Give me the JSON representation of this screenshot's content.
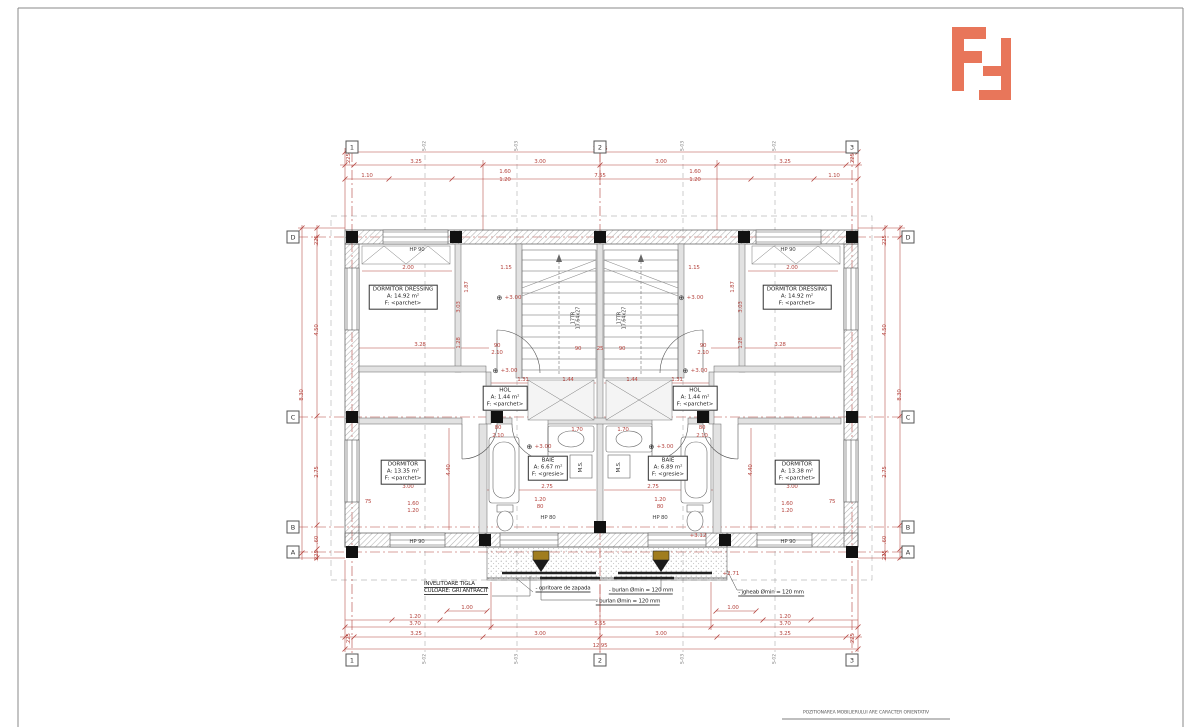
{
  "sheet": {
    "footer_note": "POZITIONAREA MOBILIERULUI ARE CARACTER ORIENTATIV",
    "logo_color": "#e8765a",
    "dim_color": "#b5453f"
  },
  "axes": {
    "cols": [
      {
        "id": "1",
        "x": 352
      },
      {
        "id": "2",
        "x": 600
      },
      {
        "id": "3",
        "x": 852
      }
    ],
    "rows": [
      {
        "id": "D",
        "y": 237
      },
      {
        "id": "C",
        "y": 417
      },
      {
        "id": "B",
        "y": 527
      },
      {
        "id": "A",
        "y": 552
      }
    ],
    "sections": [
      {
        "id": "S-02",
        "x": 425
      },
      {
        "id": "S-03",
        "x": 517
      },
      {
        "id": "S-03",
        "x": 683
      },
      {
        "id": "S-02",
        "x": 775
      }
    ]
  },
  "rooms": [
    {
      "id": "dormitor-dressing-left",
      "x": 403,
      "y": 297,
      "lines": [
        "DORMITOR DRESSING",
        "A: 14.92 m²",
        "F: <parchet>"
      ]
    },
    {
      "id": "dormitor-dressing-right",
      "x": 797,
      "y": 297,
      "lines": [
        "DORMITOR DRESSING",
        "A: 14.92 m²",
        "F: <parchet>"
      ]
    },
    {
      "id": "hol-left",
      "x": 505,
      "y": 398,
      "lines": [
        "HOL",
        "A: 1.44 m²",
        "F: <parchet>"
      ]
    },
    {
      "id": "hol-right",
      "x": 695,
      "y": 398,
      "lines": [
        "HOL",
        "A: 1.44 m²",
        "F: <parchet>"
      ]
    },
    {
      "id": "baie-left",
      "x": 548,
      "y": 468,
      "lines": [
        "BAIE",
        "A: 6.67 m²",
        "F: <gresie>"
      ]
    },
    {
      "id": "baie-right",
      "x": 668,
      "y": 468,
      "lines": [
        "BAIE",
        "A: 6.89 m²",
        "F: <gresie>"
      ]
    },
    {
      "id": "dormitor-left",
      "x": 403,
      "y": 472,
      "lines": [
        "DORMITOR",
        "A: 13.35 m²",
        "F: <parchet>"
      ]
    },
    {
      "id": "dormitor-right",
      "x": 797,
      "y": 472,
      "lines": [
        "DORMITOR",
        "A: 13.38 m²",
        "F: <parchet>"
      ]
    }
  ],
  "stairs": [
    {
      "id": "stair-left",
      "x": 577,
      "y": 318,
      "lines": [
        "17TR",
        "17.64x27"
      ]
    },
    {
      "id": "stair-right",
      "x": 623,
      "y": 318,
      "lines": [
        "17TR",
        "17.64x27"
      ]
    }
  ],
  "machines": [
    {
      "t": "M.S.",
      "x": 581,
      "y": 467
    },
    {
      "t": "M.S.",
      "x": 619,
      "y": 467
    }
  ],
  "fixture_labels": [
    {
      "t": "HP 90",
      "x": 417,
      "y": 250
    },
    {
      "t": "HP 90",
      "x": 788,
      "y": 250
    },
    {
      "t": "HP 90",
      "x": 417,
      "y": 542
    },
    {
      "t": "HP 90",
      "x": 788,
      "y": 542
    },
    {
      "t": "HP 80",
      "x": 548,
      "y": 518
    },
    {
      "t": "HP 80",
      "x": 660,
      "y": 518
    }
  ],
  "levels": [
    {
      "t": "+3.00",
      "x": 509,
      "y": 298
    },
    {
      "t": "+3.00",
      "x": 691,
      "y": 298
    },
    {
      "t": "+3.00",
      "x": 505,
      "y": 371
    },
    {
      "t": "+3.00",
      "x": 695,
      "y": 371
    },
    {
      "t": "+3.00",
      "x": 539,
      "y": 447
    },
    {
      "t": "+3.00",
      "x": 661,
      "y": 447
    }
  ],
  "red_notes": [
    {
      "t": "+3.12",
      "x": 698,
      "y": 536
    },
    {
      "t": "+2.71",
      "x": 731,
      "y": 574
    }
  ],
  "dims_h": [
    [
      "12.95",
      600,
      149
    ],
    [
      "3.25",
      416,
      162
    ],
    [
      "3.00",
      540,
      162
    ],
    [
      "3.00",
      661,
      162
    ],
    [
      "3.25",
      785,
      162
    ],
    [
      "1.10",
      367,
      176
    ],
    [
      "1.60",
      505,
      172
    ],
    [
      "1.20",
      505,
      180
    ],
    [
      "7.55",
      600,
      176
    ],
    [
      "1.60",
      695,
      172
    ],
    [
      "1.20",
      695,
      180
    ],
    [
      "1.10",
      834,
      176
    ],
    [
      "2.00",
      408,
      268
    ],
    [
      "1.15",
      506,
      268
    ],
    [
      "1.15",
      694,
      268
    ],
    [
      "2.00",
      792,
      268
    ],
    [
      "3.28",
      420,
      345
    ],
    [
      "3.28",
      780,
      345
    ],
    [
      "90",
      497,
      346
    ],
    [
      "2.10",
      497,
      353
    ],
    [
      "90",
      703,
      346
    ],
    [
      "2.10",
      703,
      353
    ],
    [
      "90",
      578,
      349
    ],
    [
      "25",
      600,
      349
    ],
    [
      "90",
      622,
      349
    ],
    [
      "1.31",
      523,
      380
    ],
    [
      "1.44",
      568,
      380
    ],
    [
      "1.44",
      632,
      380
    ],
    [
      "1.31",
      677,
      380
    ],
    [
      "80",
      498,
      428
    ],
    [
      "2.10",
      498,
      436
    ],
    [
      "80",
      702,
      428
    ],
    [
      "2.10",
      702,
      436
    ],
    [
      "1.70",
      577,
      430
    ],
    [
      "1.70",
      623,
      430
    ],
    [
      "2.75",
      547,
      487
    ],
    [
      "2.75",
      653,
      487
    ],
    [
      "3.00",
      408,
      487
    ],
    [
      "3.00",
      792,
      487
    ],
    [
      "1.20",
      540,
      500
    ],
    [
      "80",
      540,
      507
    ],
    [
      "1.20",
      660,
      500
    ],
    [
      "80",
      660,
      507
    ],
    [
      "75",
      368,
      502
    ],
    [
      "75",
      832,
      502
    ],
    [
      "1.60",
      413,
      504
    ],
    [
      "1.20",
      413,
      511
    ],
    [
      "1.60",
      787,
      504
    ],
    [
      "1.20",
      787,
      511
    ],
    [
      "1.00",
      467,
      608
    ],
    [
      "1.00",
      733,
      608
    ],
    [
      "1.20",
      415,
      617
    ],
    [
      "1.20",
      785,
      617
    ],
    [
      "3.70",
      415,
      624
    ],
    [
      "5.55",
      600,
      624
    ],
    [
      "3.70",
      785,
      624
    ],
    [
      "3.25",
      416,
      634
    ],
    [
      "3.00",
      540,
      634
    ],
    [
      "3.00",
      661,
      634
    ],
    [
      "3.25",
      785,
      634
    ],
    [
      "12.95",
      600,
      646
    ]
  ],
  "dims_v": [
    [
      ".225",
      349,
      159
    ],
    [
      ".225",
      853,
      159
    ],
    [
      ".225",
      349,
      639
    ],
    [
      ".225",
      853,
      639
    ],
    [
      "8.30",
      302,
      395
    ],
    [
      ".225",
      317,
      241
    ],
    [
      "4.50",
      317,
      330
    ],
    [
      "2.75",
      317,
      472
    ],
    [
      ".60",
      317,
      540
    ],
    [
      ".225",
      317,
      556
    ],
    [
      "8.30",
      900,
      395
    ],
    [
      ".225",
      885,
      241
    ],
    [
      "4.50",
      885,
      330
    ],
    [
      "2.75",
      885,
      472
    ],
    [
      ".60",
      885,
      540
    ],
    [
      ".225",
      885,
      556
    ],
    [
      "1.87",
      467,
      287
    ],
    [
      "1.87",
      733,
      287
    ],
    [
      "3.03",
      459,
      307
    ],
    [
      "3.03",
      741,
      307
    ],
    [
      "1.28",
      459,
      343
    ],
    [
      "1.28",
      741,
      343
    ],
    [
      "4.40",
      449,
      470
    ],
    [
      "4.40",
      751,
      470
    ]
  ],
  "notes": {
    "roof": {
      "x": 424,
      "y": 588,
      "lines": [
        "INVELITOARE TIGLA",
        "CULOARE: GRI ANTRACIT"
      ]
    },
    "snow": {
      "t": "- opritoare de zapada",
      "x": 563,
      "y": 589
    },
    "burlan1": {
      "t": "- burlan Ømin = 120 mm",
      "x": 641,
      "y": 591
    },
    "burlan2": {
      "t": "- burlan Ømin = 120 mm",
      "x": 628,
      "y": 602
    },
    "jgheab": {
      "t": "- jgheab Ømin = 120 mm",
      "x": 771,
      "y": 593
    }
  }
}
